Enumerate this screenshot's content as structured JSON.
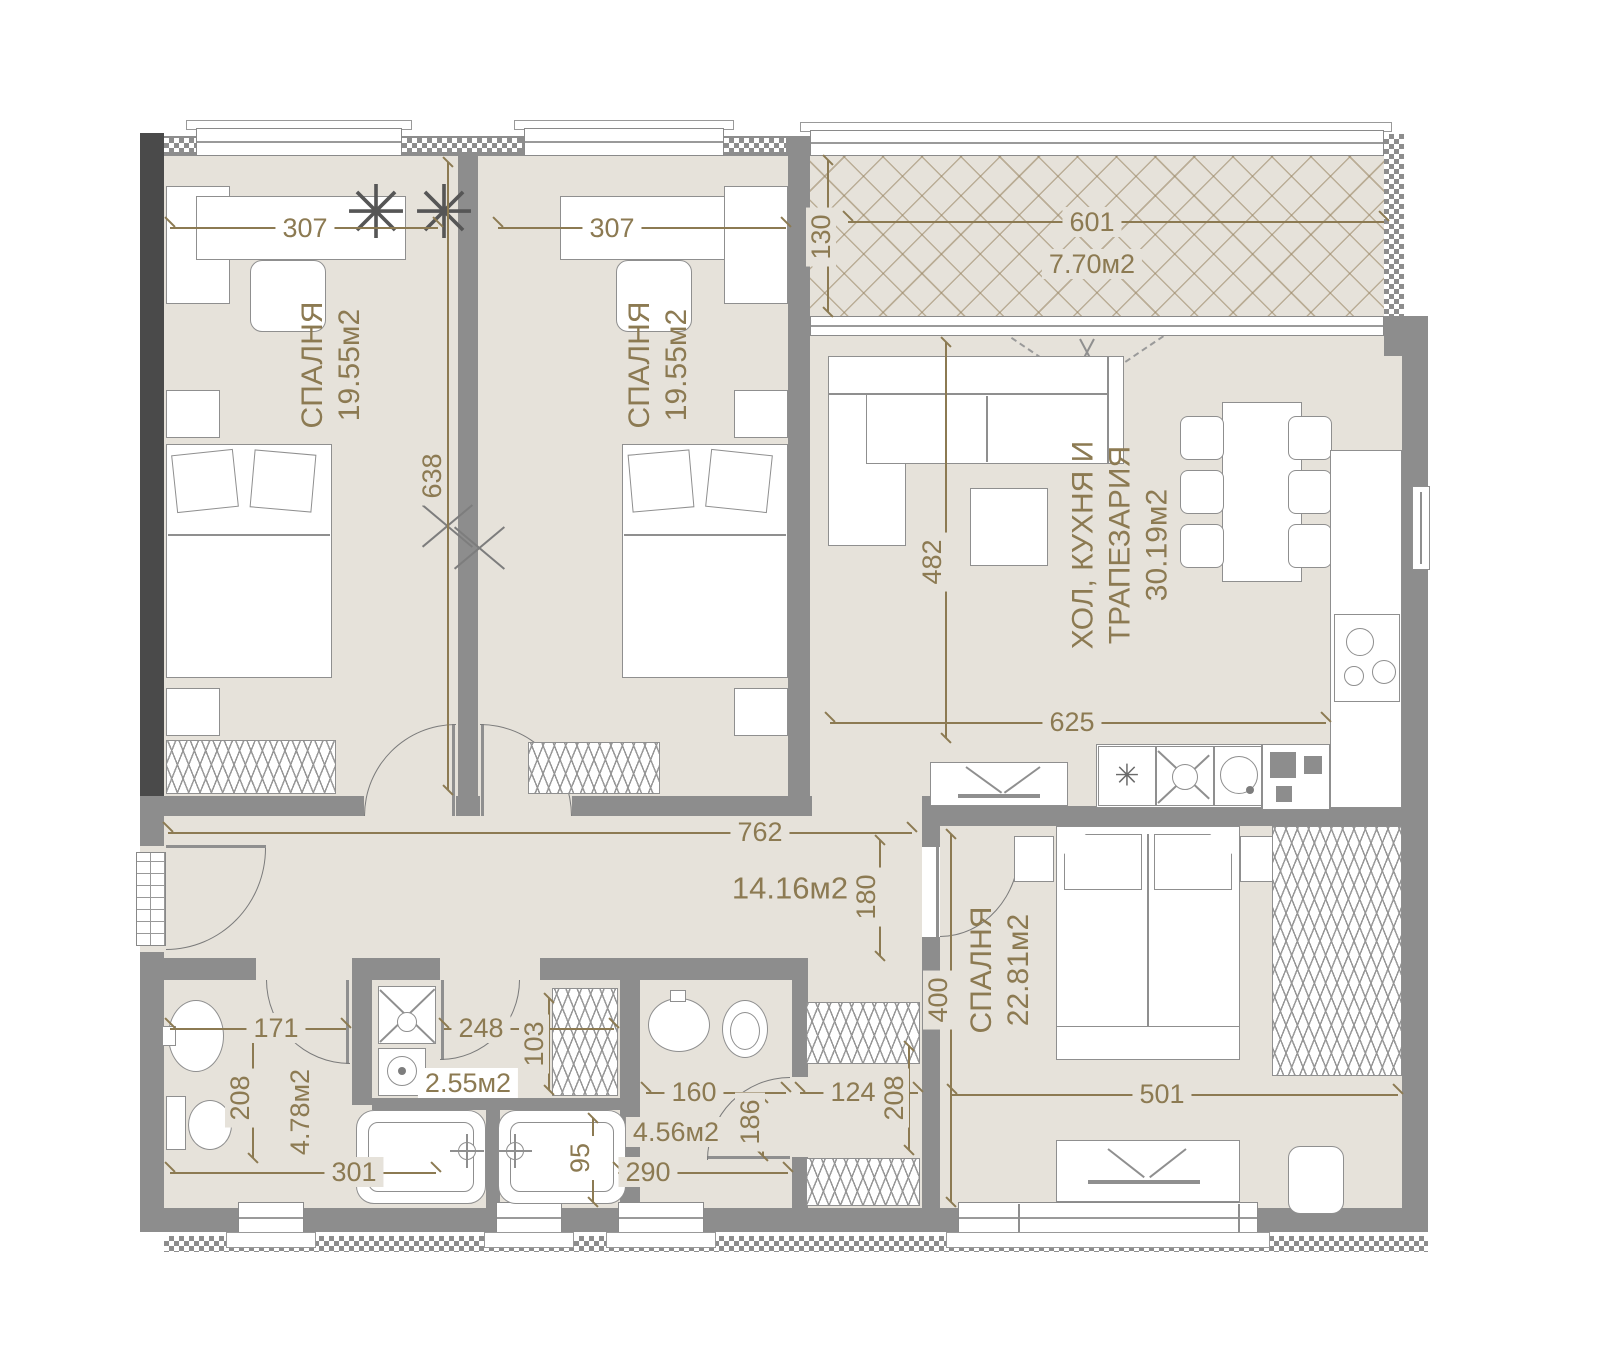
{
  "rooms": {
    "bedroom1": {
      "name": "СПАЛНЯ",
      "area": "19.55м2"
    },
    "bedroom2": {
      "name": "СПАЛНЯ",
      "area": "19.55м2"
    },
    "bedroom3": {
      "name": "СПАЛНЯ",
      "area": "22.81м2"
    },
    "living_kitchen": {
      "name_line1": "ХОЛ, КУХНЯ И",
      "name_line2": "ТРАПЕЗАРИЯ",
      "area": "30.19м2"
    },
    "balcony": {
      "area": "7.70м2"
    },
    "corridor": {
      "area": "14.16м2"
    },
    "bathroom1": {
      "area": "4.78м2"
    },
    "laundry": {
      "area": "2.55м2"
    },
    "bathroom2": {
      "area": "4.56м2"
    }
  },
  "dims": {
    "bed1_w": "307",
    "bed2_w": "307",
    "beds_d": "638",
    "balc_d": "130",
    "balc_w": "601",
    "liv_d": "482",
    "liv_w": "625",
    "corr_w": "762",
    "corr_d": "180",
    "bath1_w": "171",
    "bath1_d": "208",
    "bath1_total": "301",
    "laundry_w": "248",
    "laundry_d": "103",
    "tub_d": "95",
    "bath2_bot": "290",
    "bath2_w": "160",
    "bath2_d": "186",
    "hall_w": "124",
    "hall_d": "208",
    "bed3_d": "400",
    "bed3_w": "501"
  },
  "icons": {
    "plant": "✳",
    "dishwasher": "✳"
  },
  "colors": {
    "wall": "#8d8d8d",
    "dark_wall": "#4a4a4a",
    "floor": "#e6e2da",
    "dim_text": "#8c7a52"
  }
}
